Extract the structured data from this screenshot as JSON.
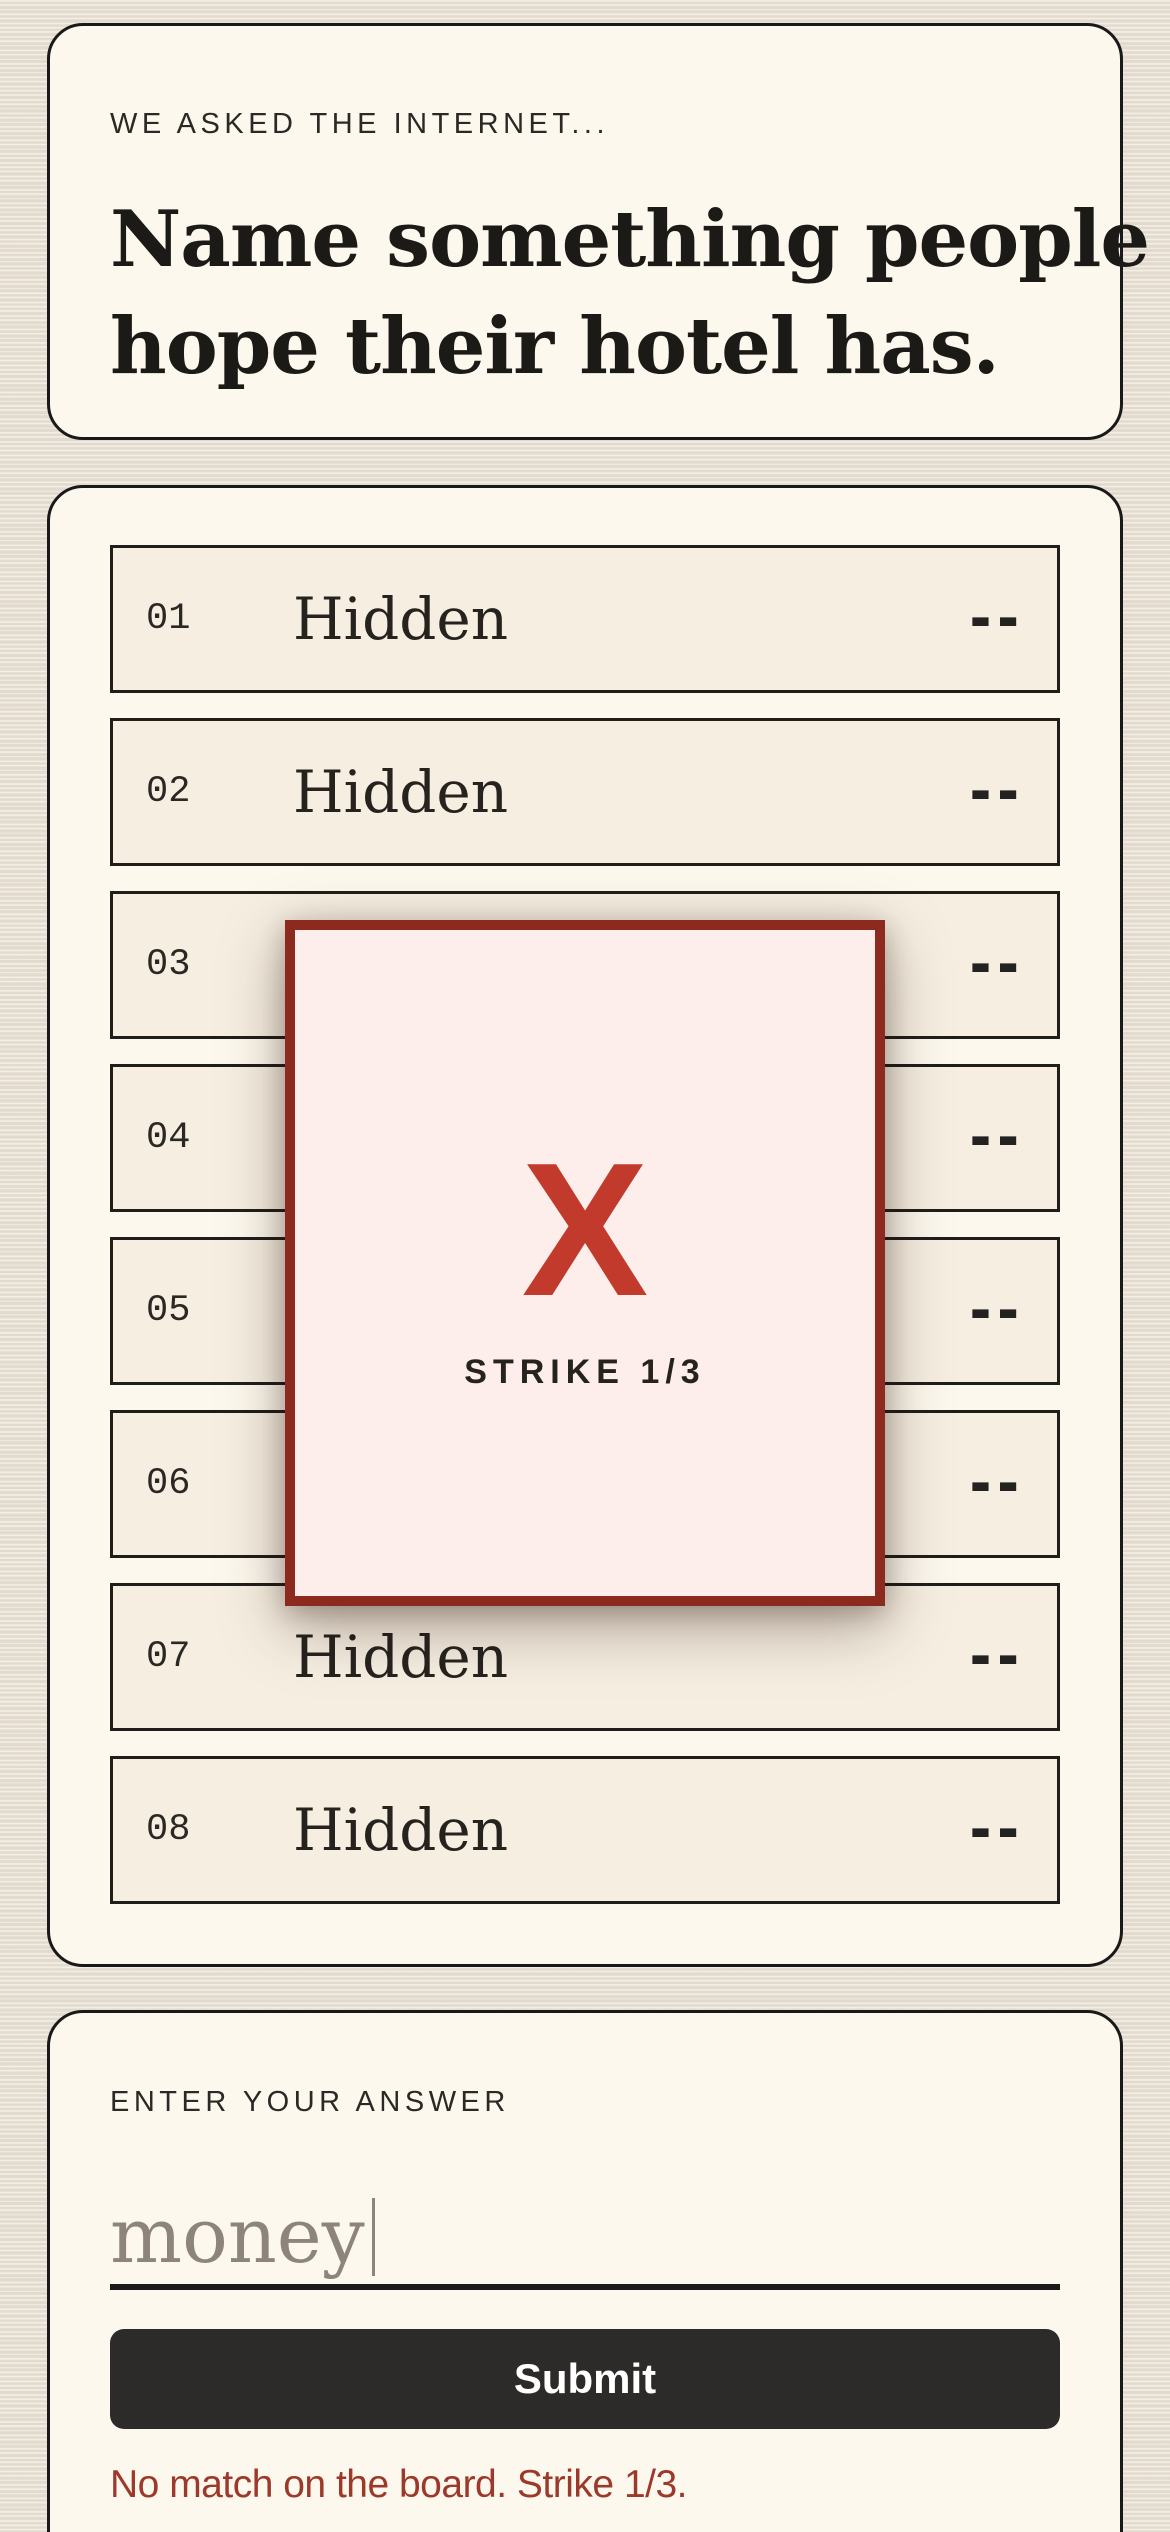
{
  "question": {
    "eyebrow": "WE ASKED THE INTERNET...",
    "title_line1": "Name something people",
    "title_line2": "hope their hotel has."
  },
  "board": {
    "rows": [
      {
        "num": "01",
        "label": "Hidden",
        "points": "--"
      },
      {
        "num": "02",
        "label": "Hidden",
        "points": "--"
      },
      {
        "num": "03",
        "label": "Hidden",
        "points": "--"
      },
      {
        "num": "04",
        "label": "Hidden",
        "points": "--"
      },
      {
        "num": "05",
        "label": "Hidden",
        "points": "--"
      },
      {
        "num": "06",
        "label": "Hidden",
        "points": "--"
      },
      {
        "num": "07",
        "label": "Hidden",
        "points": "--"
      },
      {
        "num": "08",
        "label": "Hidden",
        "points": "--"
      }
    ]
  },
  "strike": {
    "x_icon": "X",
    "label": "STRIKE 1/3"
  },
  "answer": {
    "label": "ENTER YOUR ANSWER",
    "input_value": "money",
    "submit_label": "Submit",
    "error": "No match on the board. Strike 1/3."
  },
  "colors": {
    "page_background": "#e9e1d4",
    "card_background": "#fdf8ed",
    "row_background": "#f6efe1",
    "strike_border": "#8d2a20",
    "strike_background": "#fdeeeb",
    "strike_x": "#c23a2b",
    "submit_background": "#2d2b2a",
    "error_text": "#9c392a"
  }
}
